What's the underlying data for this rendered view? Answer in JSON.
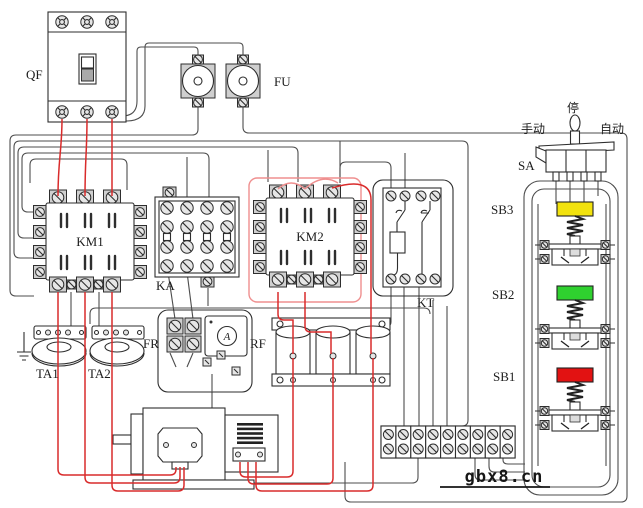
{
  "diagram": {
    "watermark": "gbx8.cn",
    "components": {
      "qf": {
        "label": "QF",
        "type": "circuit-breaker"
      },
      "fu": {
        "label": "FU",
        "type": "fuses"
      },
      "km1": {
        "label": "KM1",
        "type": "contactor"
      },
      "ka": {
        "label": "KA",
        "type": "relay"
      },
      "km2": {
        "label": "KM2",
        "type": "contactor"
      },
      "kt": {
        "label": "KT",
        "type": "time-relay"
      },
      "fr": {
        "label": "FR",
        "type": "thermal-relay"
      },
      "rf": {
        "label": "RF",
        "type": "rheostat"
      },
      "ta1": {
        "label": "TA1",
        "type": "current-transformer"
      },
      "ta2": {
        "label": "TA2",
        "type": "current-transformer"
      },
      "sa": {
        "label": "SA",
        "type": "selector-switch"
      },
      "sb1": {
        "label": "SB1",
        "cap_color": "#e21212",
        "type": "pushbutton"
      },
      "sb2": {
        "label": "SB2",
        "cap_color": "#2fd12f",
        "type": "pushbutton"
      },
      "sb3": {
        "label": "SB3",
        "cap_color": "#f2e20e",
        "type": "pushbutton"
      },
      "ammeter": {
        "label": "A",
        "type": "ammeter"
      }
    },
    "selector_positions": {
      "stop": "停",
      "manual": "手动",
      "auto": "自动"
    },
    "colors": {
      "wire": "#4d4d4d",
      "power_wire": "#d92b2b",
      "jumper_wire": "#ef8f8f",
      "outline": "#2e2e2e",
      "cap_yellow": "#f2e20e",
      "cap_green": "#2fd12f",
      "cap_red": "#e21212"
    }
  }
}
